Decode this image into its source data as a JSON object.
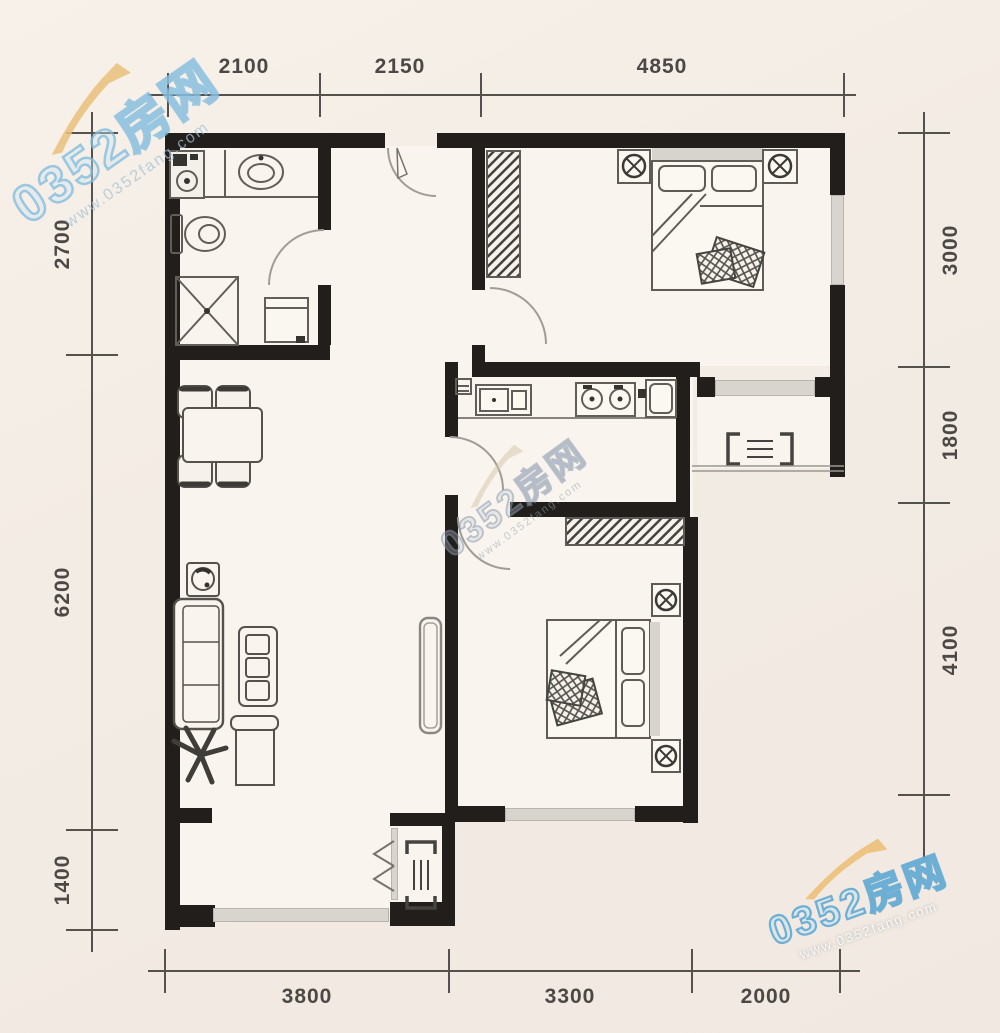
{
  "watermark": {
    "brand": "0352房网",
    "url": "www.0352fang.com"
  },
  "dims": {
    "top": [
      "2100",
      "2150",
      "4850"
    ],
    "bottom": [
      "3800",
      "3300",
      "2000"
    ],
    "left": [
      "2700",
      "6200",
      "1400"
    ],
    "right": [
      "3000",
      "1800",
      "4100"
    ]
  },
  "colors": {
    "wall": "#211e1b",
    "dimension_text": "#4b4845",
    "window_band": "#d8d4ce",
    "watermark_blue": "#8cc0e2",
    "watermark_yellow": "#eac27c",
    "background": "#f3ecE4"
  }
}
